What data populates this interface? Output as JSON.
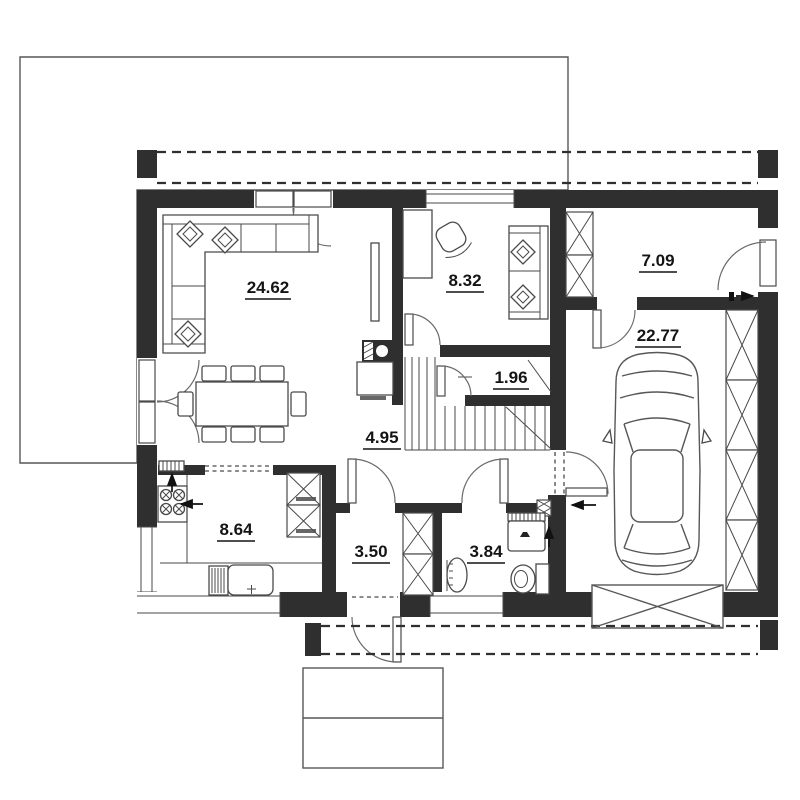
{
  "plan_title": "house-ground-floor-plan",
  "rooms": [
    {
      "id": "living-room",
      "area": "24.62"
    },
    {
      "id": "office",
      "area": "8.32"
    },
    {
      "id": "entry-vestibule",
      "area": "7.09"
    },
    {
      "id": "garage",
      "area": "22.77"
    },
    {
      "id": "understair-storage",
      "area": "1.96"
    },
    {
      "id": "hall",
      "area": "4.95"
    },
    {
      "id": "kitchen",
      "area": "8.64"
    },
    {
      "id": "utility-room",
      "area": "3.50"
    },
    {
      "id": "bathroom",
      "area": "3.84"
    }
  ],
  "colors": {
    "wall": "#2f2f2f",
    "line": "#4a4a4a",
    "text": "#141414",
    "bg": "#ffffff"
  }
}
